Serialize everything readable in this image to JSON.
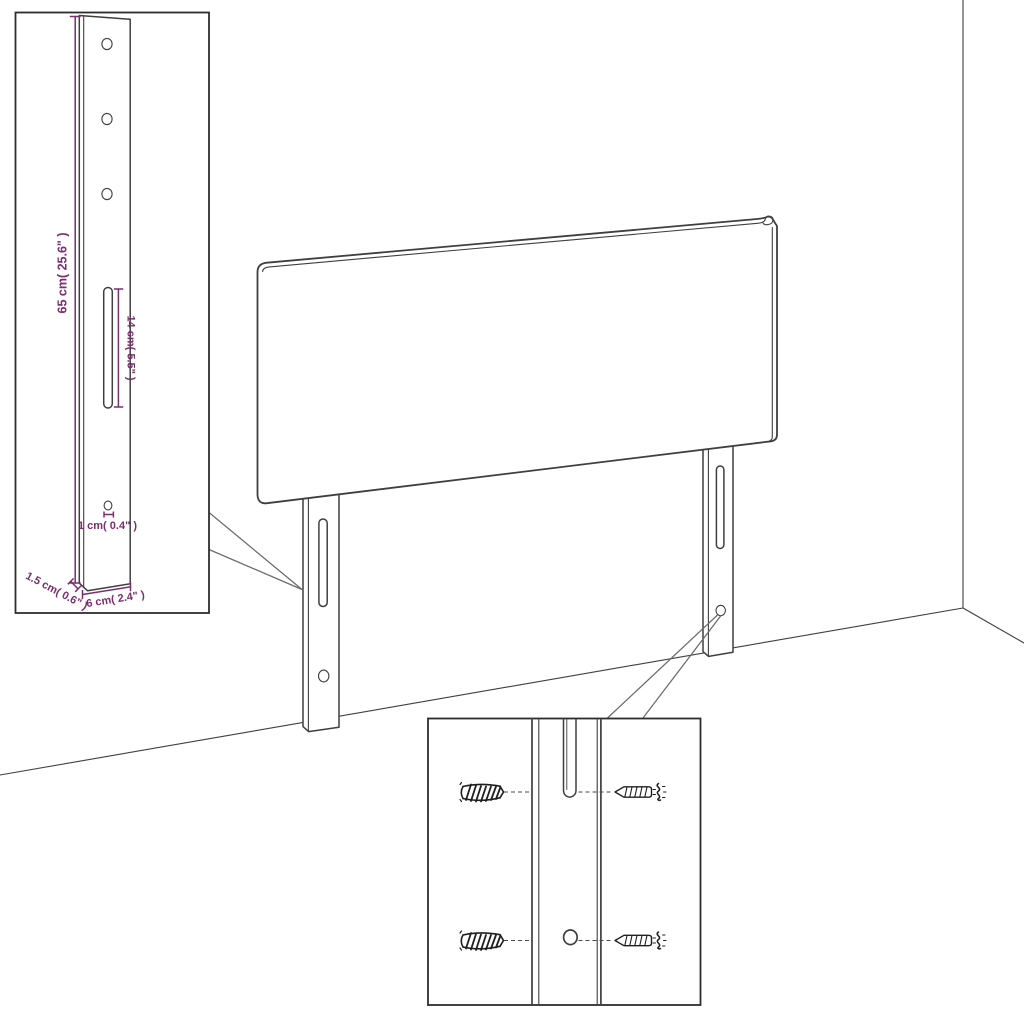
{
  "diagram": {
    "kind": "headboard-assembly-dimension-diagram",
    "background_color": "#ffffff",
    "line_color": "#3f3f3f",
    "dimension_color": "#7c2d6e",
    "hardware_color": "#1f1f1f"
  },
  "insets": {
    "leg_detail": {
      "name": "mounting-leg-detail",
      "dimensions": {
        "height": "65 cm( 25.6\" )",
        "slot_length": "14 cm( 5.5\" )",
        "hole_diameter": "1 cm( 0.4\" )",
        "thickness": "1.5 cm( 0.6\" )",
        "width": "6 cm( 2.4\" )"
      }
    },
    "mounting_detail": {
      "name": "screw-and-anchor-detail",
      "icons": [
        "wall-anchor-icon",
        "screw-icon",
        "slot-icon",
        "hole-icon"
      ]
    }
  },
  "scene": {
    "parts": [
      "headboard-panel",
      "left-mounting-leg",
      "right-mounting-leg",
      "room-corner"
    ]
  }
}
